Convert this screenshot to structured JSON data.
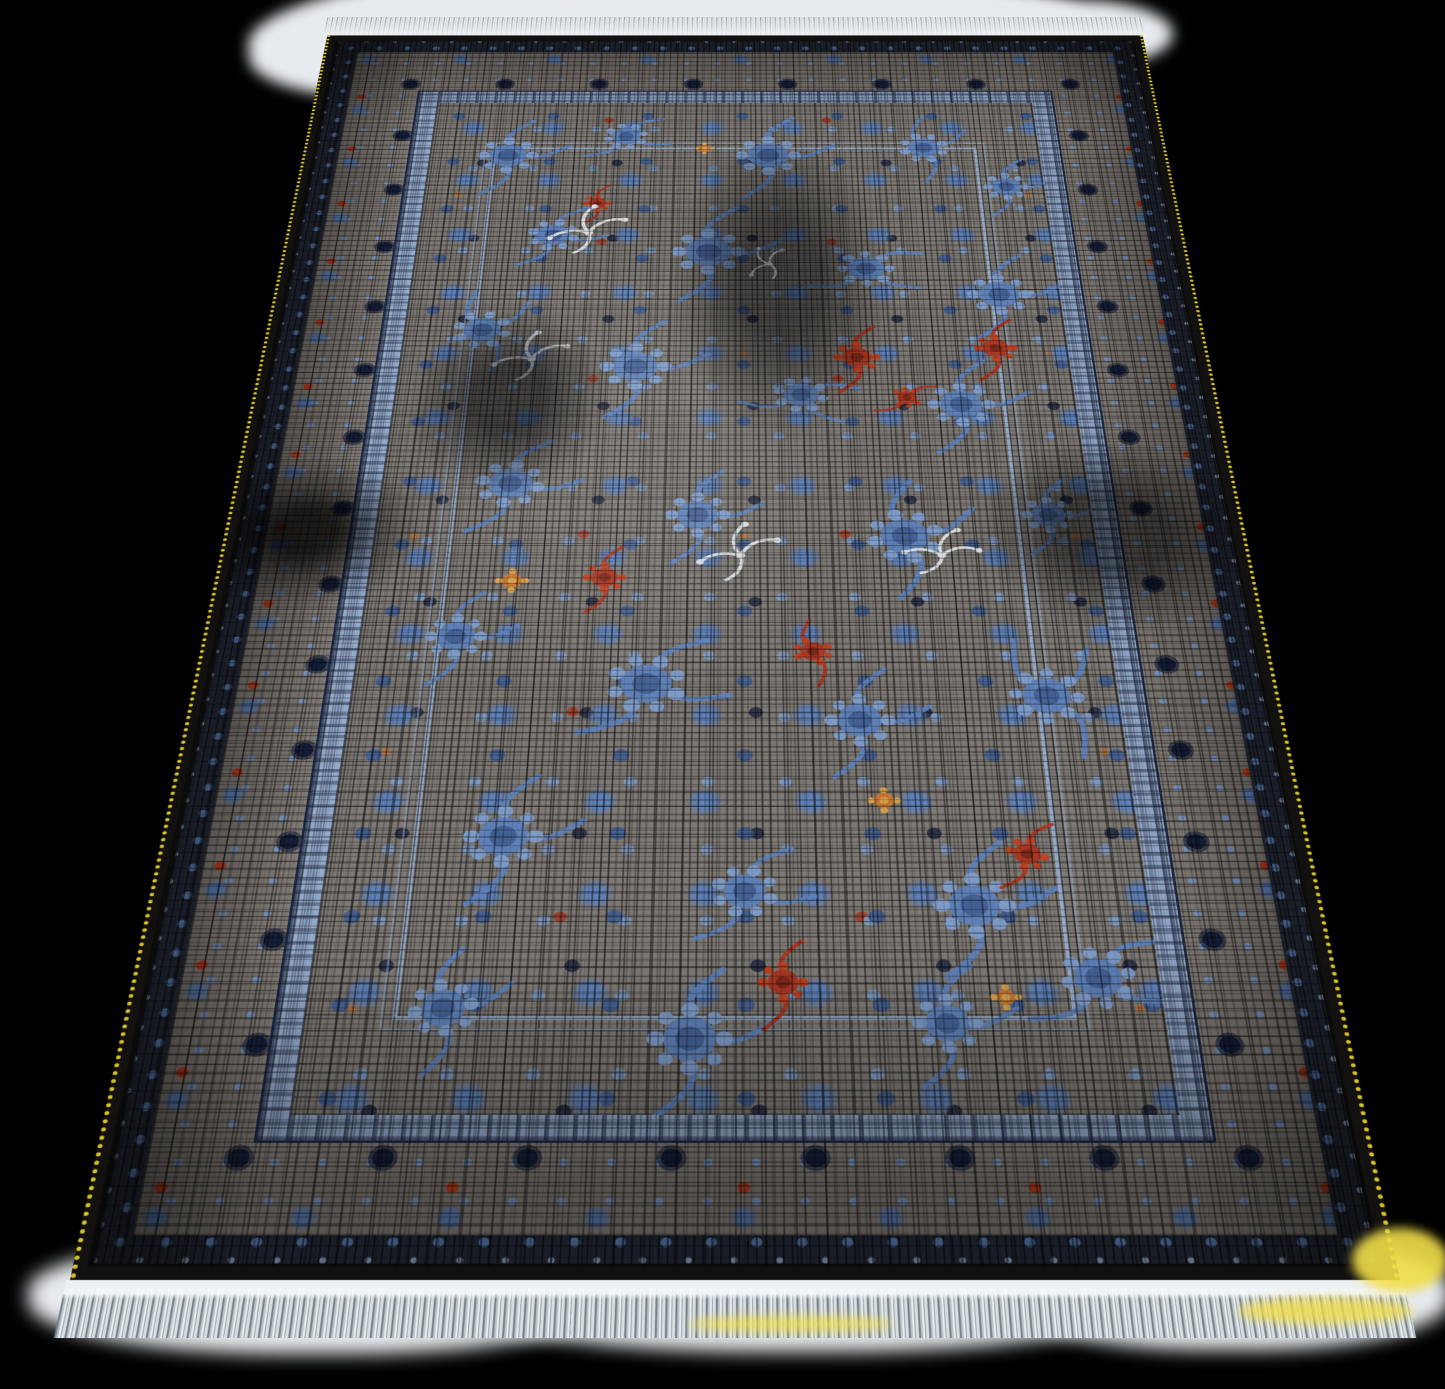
{
  "scene": {
    "type": "product photograph",
    "subject": "distressed Persian-style area rug photographed at an angle on an over-exposed white floor",
    "background_color": "#000000",
    "floor_highlight_color": "#e7eaee"
  },
  "rug": {
    "shape": "rectangle seen in floor perspective, far edge narrower at top",
    "style": "vintage distressed floral",
    "field_description": "dense slate-blue floral sprays with scattered red, orange and silver-white accents over an abraded grey and black crosshatched ground",
    "border_description": "wide grey main border with navy ornaments, blue rosettes and red flowers, flanked by a dark outer guard and a light-blue inner guard stripe, black outer edge",
    "inner_frame_description": "thin double light-blue rectangle inset within the field",
    "fringe_top": {
      "label": "short white fringe",
      "color": "#e4e8ec"
    },
    "fringe_bottom": {
      "label": "long silver-grey fringe with white selvage band",
      "color": "#b9c2c8"
    },
    "selvage": {
      "label": "golden-yellow beaded side edge",
      "color": "#d7c327"
    },
    "sunlight": {
      "label": "yellow sunlight patches near bottom edge",
      "color": "#f2de4a"
    }
  },
  "colors": {
    "bg": "#000000",
    "floorWhite": "#e7eaee",
    "pileBlack": "#121110",
    "borderGrey": "#867f79",
    "fieldGrey": "#7e7974",
    "navy": "#16203e",
    "flowerBlue": "#5d81ba",
    "flowerBlueDeep": "#415f96",
    "flowerBlueLight": "#7e9dcb",
    "guardBlue": "#93a9c9",
    "red": "#ab3520",
    "redBright": "#c23f1e",
    "orange": "#c9742f",
    "gold": "#dca44a",
    "silver": "#dde2e6",
    "selvage": "#d7c327",
    "fringeTop": "#e4e8ec",
    "fringeStrand": "#9aa5ab",
    "fringeBottom": "#b9c2c8",
    "sunspot": "#f2de4a"
  }
}
